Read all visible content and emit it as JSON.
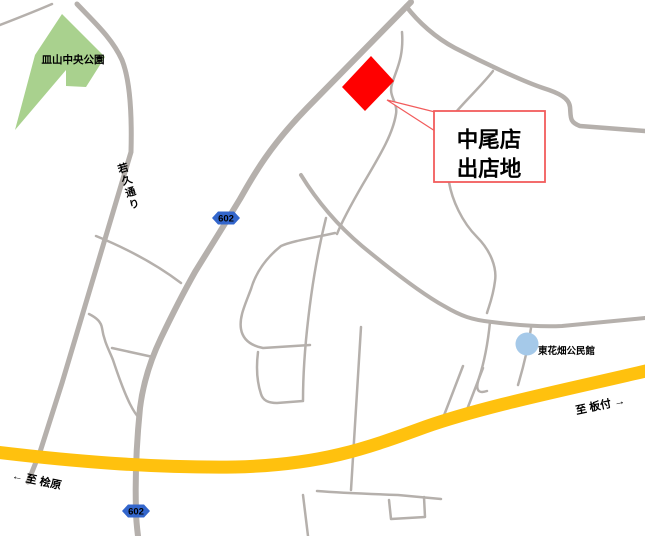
{
  "map": {
    "park_label": "皿山中央公園",
    "callout": {
      "line1": "中尾店",
      "line2": "出店地"
    },
    "road_name_label": "若久通り",
    "route_badge_label": "602",
    "facility_label": "東花畑公民館",
    "direction_left_label": "← 至 桧原",
    "direction_right_label": "至 板付 →",
    "colors": {
      "background": "#FFFFFF",
      "road_gray": "#B5B0AC",
      "park_green": "#A9D18E",
      "site_red": "#FF0000",
      "callout_border_red": "#F25C5C",
      "highway_orange": "#FFC10E",
      "route_badge_blue": "#3366CC",
      "route_badge_text": "#FFFFFF",
      "facility_circle_blue": "#A5C9E9",
      "label_text": "#000000"
    }
  }
}
